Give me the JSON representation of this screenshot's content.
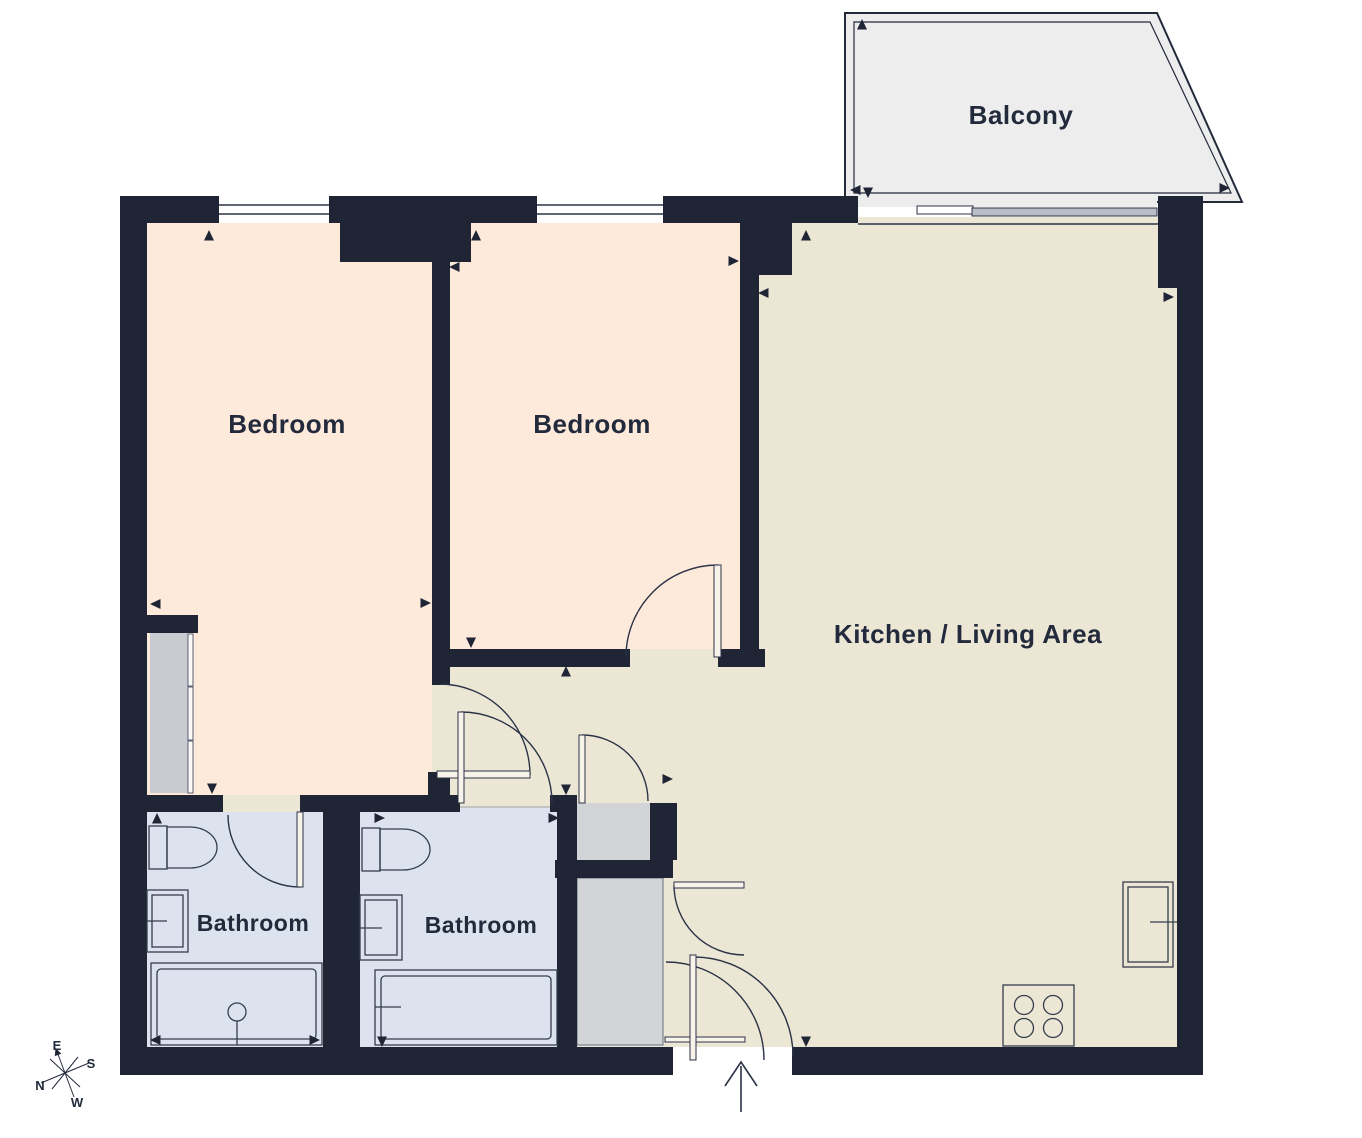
{
  "plan": {
    "rooms": {
      "bedroom_1": "Bedroom",
      "bedroom_2": "Bedroom",
      "kitchen_living": "Kitchen / Living Area",
      "bathroom_1": "Bathroom",
      "bathroom_2": "Bathroom",
      "balcony": "Balcony"
    },
    "compass": {
      "n": "N",
      "e": "E",
      "s": "S",
      "w": "W"
    },
    "colors": {
      "wall": "#1f2535",
      "bedroom_fill": "#fdeadb",
      "living_fill": "#ece7d5",
      "bathroom_fill": "#dde3ee",
      "closet_fill": "#d2d4d8",
      "wardrobe_fill": "#c9cbd0",
      "balcony_fill": "#ededee",
      "label_text": "#222a3c"
    }
  }
}
